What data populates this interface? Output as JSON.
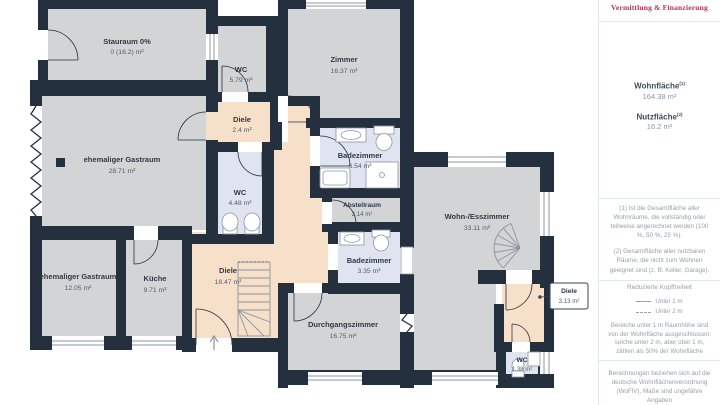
{
  "rooms": {
    "stauraum": {
      "name": "Stauraum 0%",
      "area": "0 (16.2) m²"
    },
    "wc1": {
      "name": "WC",
      "area": "5.79 m²"
    },
    "zimmer": {
      "name": "Zimmer",
      "area": "16.37 m²"
    },
    "diele1": {
      "name": "Diele",
      "area": "2.4 m²"
    },
    "badezimmer1": {
      "name": "Badezimmer",
      "area": "6.54 m²"
    },
    "gastraum1": {
      "name": "ehemaliger Gastraum",
      "area": "28.71 m²"
    },
    "wc2": {
      "name": "WC",
      "area": "4.48 m²"
    },
    "abstellraum": {
      "name": "Abstellraum",
      "area": "2.14 m²"
    },
    "wohnesszimmer": {
      "name": "Wohn-/Esszimmer",
      "area": "33.11 m²"
    },
    "badezimmer2": {
      "name": "Badezimmer",
      "area": "3.35 m²"
    },
    "gastraum2": {
      "name": "ehemaliger Gastraum",
      "area": "12.05 m²"
    },
    "kueche": {
      "name": "Küche",
      "area": "9.71 m²"
    },
    "diele2": {
      "name": "Diele",
      "area": "18.47 m²"
    },
    "durchgangszimmer": {
      "name": "Durchgangszimmer",
      "area": "16.75 m²"
    },
    "diele3": {
      "name": "Diele",
      "area": "3.13 m²"
    },
    "wc3": {
      "name": "WC",
      "area": "1.38 m²"
    }
  },
  "panel": {
    "logo": "Vermittlung & Finanzierung",
    "wohnflaeche_label": "Wohnfläche",
    "wohnflaeche_sup": "(1)",
    "wohnflaeche_value": "164.38 m²",
    "nutzflaeche_label": "Nutzfläche",
    "nutzflaeche_sup": "(2)",
    "nutzflaeche_value": "16.2 m²",
    "footnote1": "(1) Ist die Gesamtfläche aller Wohnräume, die vollständig oder teilweise angerechnet werden (100 %, 50 %, 25 %).",
    "footnote2": "(2) Gesamtfläche aller nutzbaren Räume, die nicht zum Wohnen geeignet sind (z. B. Keller, Garage).",
    "headroom_title": "Reduzierte Kopffreiheit",
    "legend_under1": "Unter 1 m",
    "legend_under2": "Unter 2 m",
    "headroom_text": "Bereiche unter 1 m Raumhöhe sind von der Wohnfläche ausgeschlossen; solche unter 2 m, aber über 1 m, zählen als 50% der Wohnfläche",
    "disclaimer": "Berechnungen beziehen sich auf die deutsche Wohnflächenverordnung (WoFlV), Maße sind ungefähre Angaben"
  },
  "colors": {
    "wall": "#25303f",
    "room_gray": "#d3d4d6",
    "hall_peach": "#f7e0ca",
    "bath_blue": "#e0e4f0",
    "logo_red": "#b23456"
  },
  "icons": {
    "entry_arrow": "↑"
  }
}
